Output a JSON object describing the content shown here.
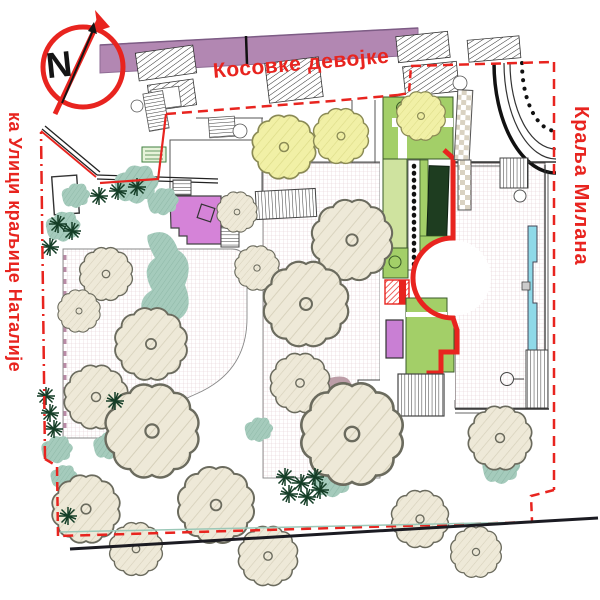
{
  "plan": {
    "north_label": "N",
    "streets": {
      "top": "Косовке девојке",
      "left": "ка Улици краљице Наталије",
      "right": "Краља Милана"
    },
    "colors": {
      "boundary_red": "#e8241f",
      "building_purple": "#b287b2",
      "lawn_green": "#a3cf68",
      "lawn_light": "#cfe39f",
      "hedge_dark": "#1e3d20",
      "plaza_magenta": "#d583d8",
      "bed_violet": "#c97fd4",
      "water_cyan": "#8fd9e8",
      "patch_pink": "#d9a9c6",
      "patch_mauve": "#b5939f",
      "tree_cream": "#eee9d8",
      "tree_yellow": "#f1f0a6",
      "shrub_teal": "#a5cbbc",
      "conifer_green": "#143d26",
      "grid_line": "#e3cdd1"
    }
  }
}
